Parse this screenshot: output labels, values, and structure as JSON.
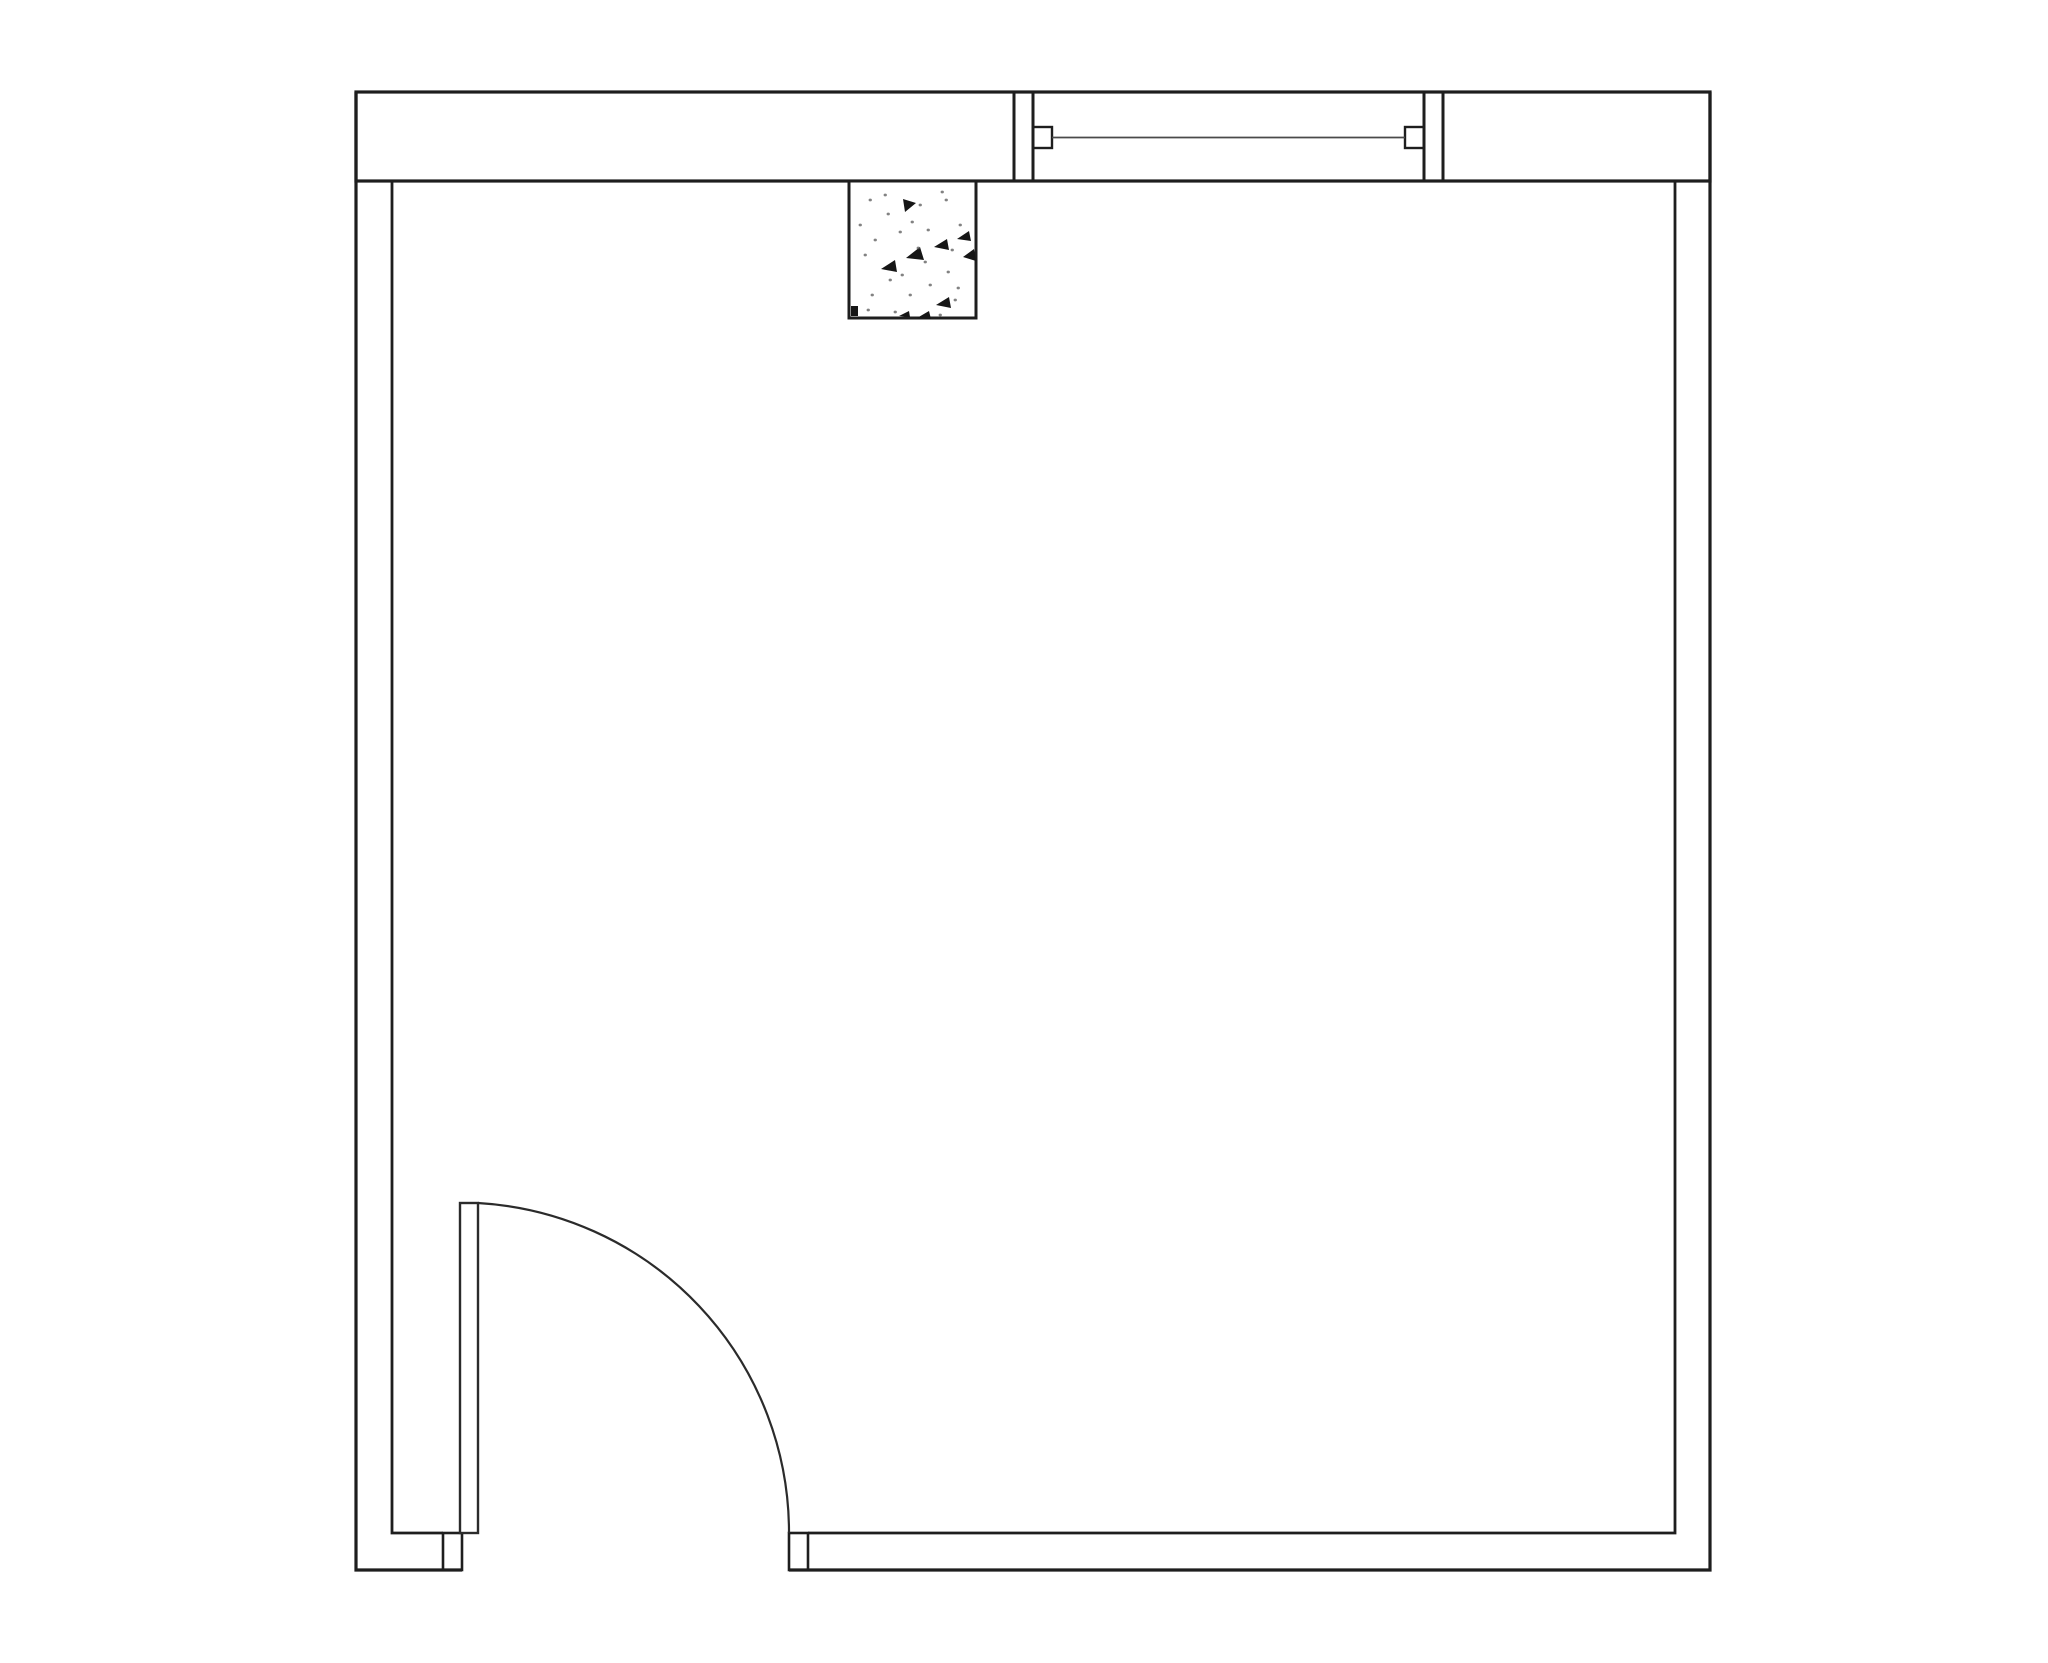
{
  "drawing": {
    "kind": "floor-plan",
    "background_color": "#ffffff",
    "wall_color": "#1e1e1e",
    "door_color": "#2b2b2b",
    "glass_line_color": "#4a4a4a",
    "stipple_color": "#161616",
    "stipple_dot_color": "#585858",
    "elements": {
      "exterior_wall": "thick top exterior wall band",
      "window": "window with jambs, end caps and glass line",
      "column": "stippled concrete column below top wall",
      "door": "door leaf with quarter-circle swing arc at bottom-left opening",
      "room": "rectangular room outline with double-line walls"
    }
  }
}
